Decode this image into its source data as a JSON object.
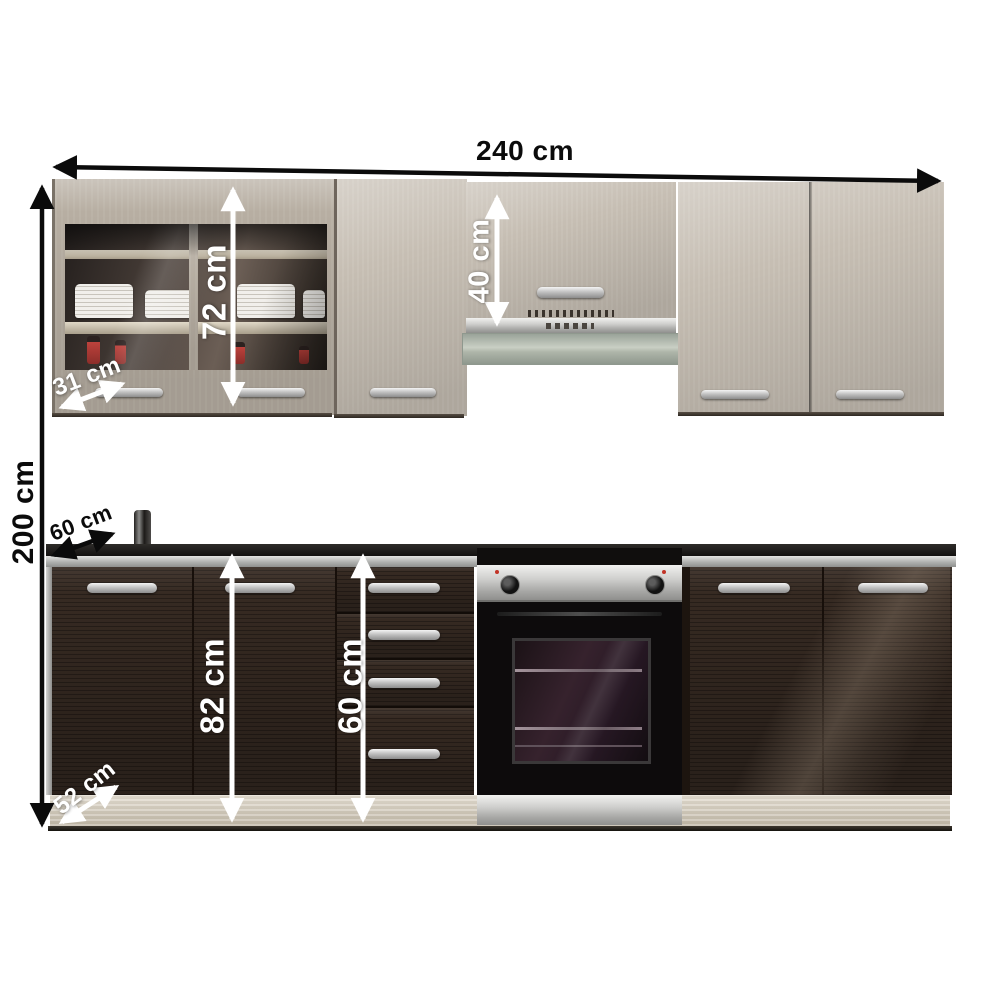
{
  "image": {
    "description": "kitchen cabinet set product photo with dimension arrows",
    "background": "#ffffff"
  },
  "dimensions": {
    "total_width": {
      "label": "240 cm",
      "orientation": "horizontal",
      "color": "#0b0b0b"
    },
    "total_height": {
      "label": "200 cm",
      "orientation": "vertical",
      "color": "#0b0b0b"
    },
    "upper_cabinet_height": {
      "label": "72 cm",
      "orientation": "vertical",
      "color": "#ffffff"
    },
    "hood_cabinet_height": {
      "label": "40 cm",
      "orientation": "vertical",
      "color": "#ffffff"
    },
    "upper_cabinet_depth": {
      "label": "31 cm",
      "orientation": "diagonal",
      "color": "#ffffff"
    },
    "worktop_depth": {
      "label": "60 cm",
      "orientation": "diagonal",
      "color": "#0b0b0b"
    },
    "base_cabinet_height": {
      "label": "82 cm",
      "orientation": "vertical",
      "color": "#ffffff"
    },
    "drawer_unit_height": {
      "label": "60 cm",
      "orientation": "vertical",
      "color": "#ffffff"
    },
    "base_cabinet_depth": {
      "label": "52 cm",
      "orientation": "diagonal",
      "color": "#ffffff"
    }
  },
  "colors": {
    "upper_cabinet_wood": "#b7aea2",
    "base_cabinet_wenge": "#362a22",
    "countertop_surface": "#1b1917",
    "countertop_edge": "#b9bab8",
    "handle_metal": "#c2c2c2",
    "appliance_steel": "#d7d7d5",
    "oven_door": "#0d0b0c",
    "plinth_wood": "#d5cbb8",
    "glass_reflection": "#4a403a",
    "bottle_red": "#bd423c"
  }
}
